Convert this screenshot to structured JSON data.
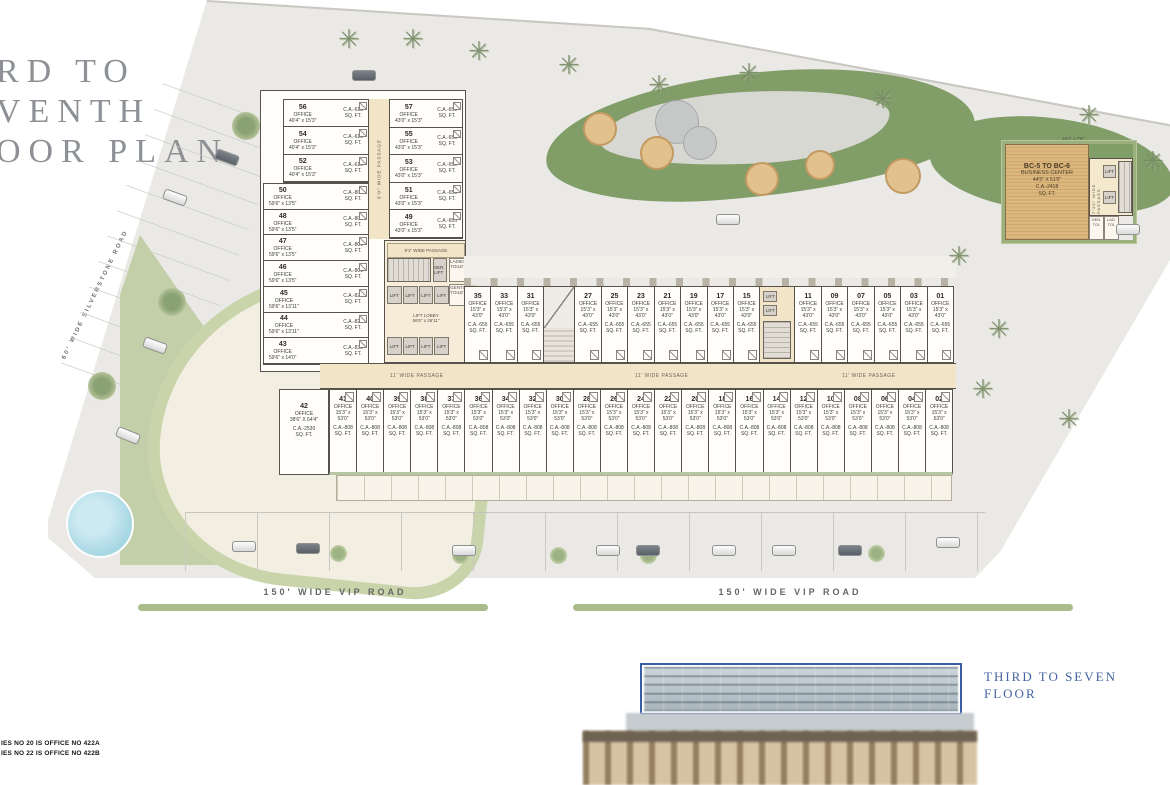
{
  "title": {
    "line1": "RD TO",
    "line2": "VENTH",
    "line3": "OOR PLAN"
  },
  "roads": {
    "silverstone": "60' WIDE SILVERSTONE ROAD",
    "vip_left": "150' WIDE VIP ROAD",
    "vip_right": "150' WIDE VIP ROAD"
  },
  "notes": {
    "line1": "IES NO 20 IS OFFICE NO 422A",
    "line2": "IES NO 22 IS OFFICE NO 422B"
  },
  "elevation": {
    "label_line1": "THIRD TO SEVEN",
    "label_line2": "FLOOR"
  },
  "shared": {
    "office": "OFFICE",
    "sq": "SQ. FT.",
    "lift": "LIFT"
  },
  "wing": {
    "col_a_top": [
      {
        "n": "56",
        "dim": "40'4\" x 15'3\"",
        "ca": "C.A.-615"
      },
      {
        "n": "54",
        "dim": "40'4\" x 15'3\"",
        "ca": "C.A.-615"
      },
      {
        "n": "52",
        "dim": "40'4\" x 15'3\"",
        "ca": "C.A.-615"
      }
    ],
    "col_a_bot": [
      {
        "n": "50",
        "dim": "59'6\" x 13'5\"",
        "ca": "C.A.-801"
      },
      {
        "n": "48",
        "dim": "59'6\" x 13'5\"",
        "ca": "C.A.-801"
      },
      {
        "n": "47",
        "dim": "59'6\" x 13'5\"",
        "ca": "C.A.-801"
      },
      {
        "n": "46",
        "dim": "59'6\" x 13'5\"",
        "ca": "C.A.-801"
      },
      {
        "n": "45",
        "dim": "59'6\" x 13'11\"",
        "ca": "C.A.-829"
      },
      {
        "n": "44",
        "dim": "59'6\" x 13'11\"",
        "ca": "C.A.-829"
      },
      {
        "n": "43",
        "dim": "59'6\" x 14'0\"",
        "ca": "C.A.-832"
      }
    ],
    "col_b": [
      {
        "n": "57",
        "dim": "43'0\" x 15'3\"",
        "ca": "C.A.-655"
      },
      {
        "n": "55",
        "dim": "43'0\" x 15'3\"",
        "ca": "C.A.-655"
      },
      {
        "n": "53",
        "dim": "43'0\" x 15'3\"",
        "ca": "C.A.-655"
      },
      {
        "n": "51",
        "dim": "43'0\" x 15'3\"",
        "ca": "C.A.-655"
      },
      {
        "n": "49",
        "dim": "43'0\" x 15'3\"",
        "ca": "C.A.-655"
      }
    ]
  },
  "core": {
    "passage_v": "9'0\" WIDE PASSAGE",
    "passage_91": "9'1\" WIDE PASSAGE",
    "ser_lift": "SER. LIFT",
    "ladies": "LADIES TOILET",
    "gents": "GENTS TOILET",
    "lobby": "LIFT LOBBY",
    "lobby_dim": "56'6\" x 26'11\"",
    "passage_11": "11' WIDE PASSAGE"
  },
  "slab": {
    "top_dim1": "15'3\" x",
    "top_dim2": "43'0\"",
    "top_ca": "C.A.-655",
    "bot_dim1": "15'3\" x",
    "bot_dim2": "53'0\"",
    "bot_ca": "C.A.-808",
    "top_left": [
      "35",
      "33",
      "31"
    ],
    "top_mid": [
      "27",
      "25",
      "23",
      "21",
      "19",
      "17",
      "15"
    ],
    "top_right": [
      "11",
      "09",
      "07",
      "05",
      "03",
      "01"
    ],
    "bottom": [
      "41",
      "40",
      "39",
      "38",
      "37",
      "36",
      "34",
      "32",
      "30",
      "28",
      "26",
      "24",
      "22",
      "20",
      "18",
      "16",
      "14",
      "12",
      "10",
      "08",
      "06",
      "04",
      "02"
    ],
    "unit42": {
      "n": "42",
      "dim": "38'6\" X 64'4\"",
      "ca": "C.A.-2530"
    }
  },
  "business_center": {
    "title": "BC-5 TO BC-6",
    "subtitle": "BUSINESS CENTER",
    "dim": "44'5\" X 51'0\"",
    "ca": "C.A.-2418",
    "sq": "SQ. FT.",
    "top_dim": "16'1\" x 7'6\"",
    "passage": "7'10\" WIDE PASSAGE",
    "gen_toi": "GEN. TOI.",
    "lad_toi": "LAD. TOI."
  },
  "colors": {
    "accent_blue": "#44639f",
    "site_gray": "#eae9e6",
    "passage_tan": "#f2e4c7",
    "bc_tan": "#dcb87f",
    "garden_green": "#819d68",
    "median_green": "#a8bd8b"
  }
}
